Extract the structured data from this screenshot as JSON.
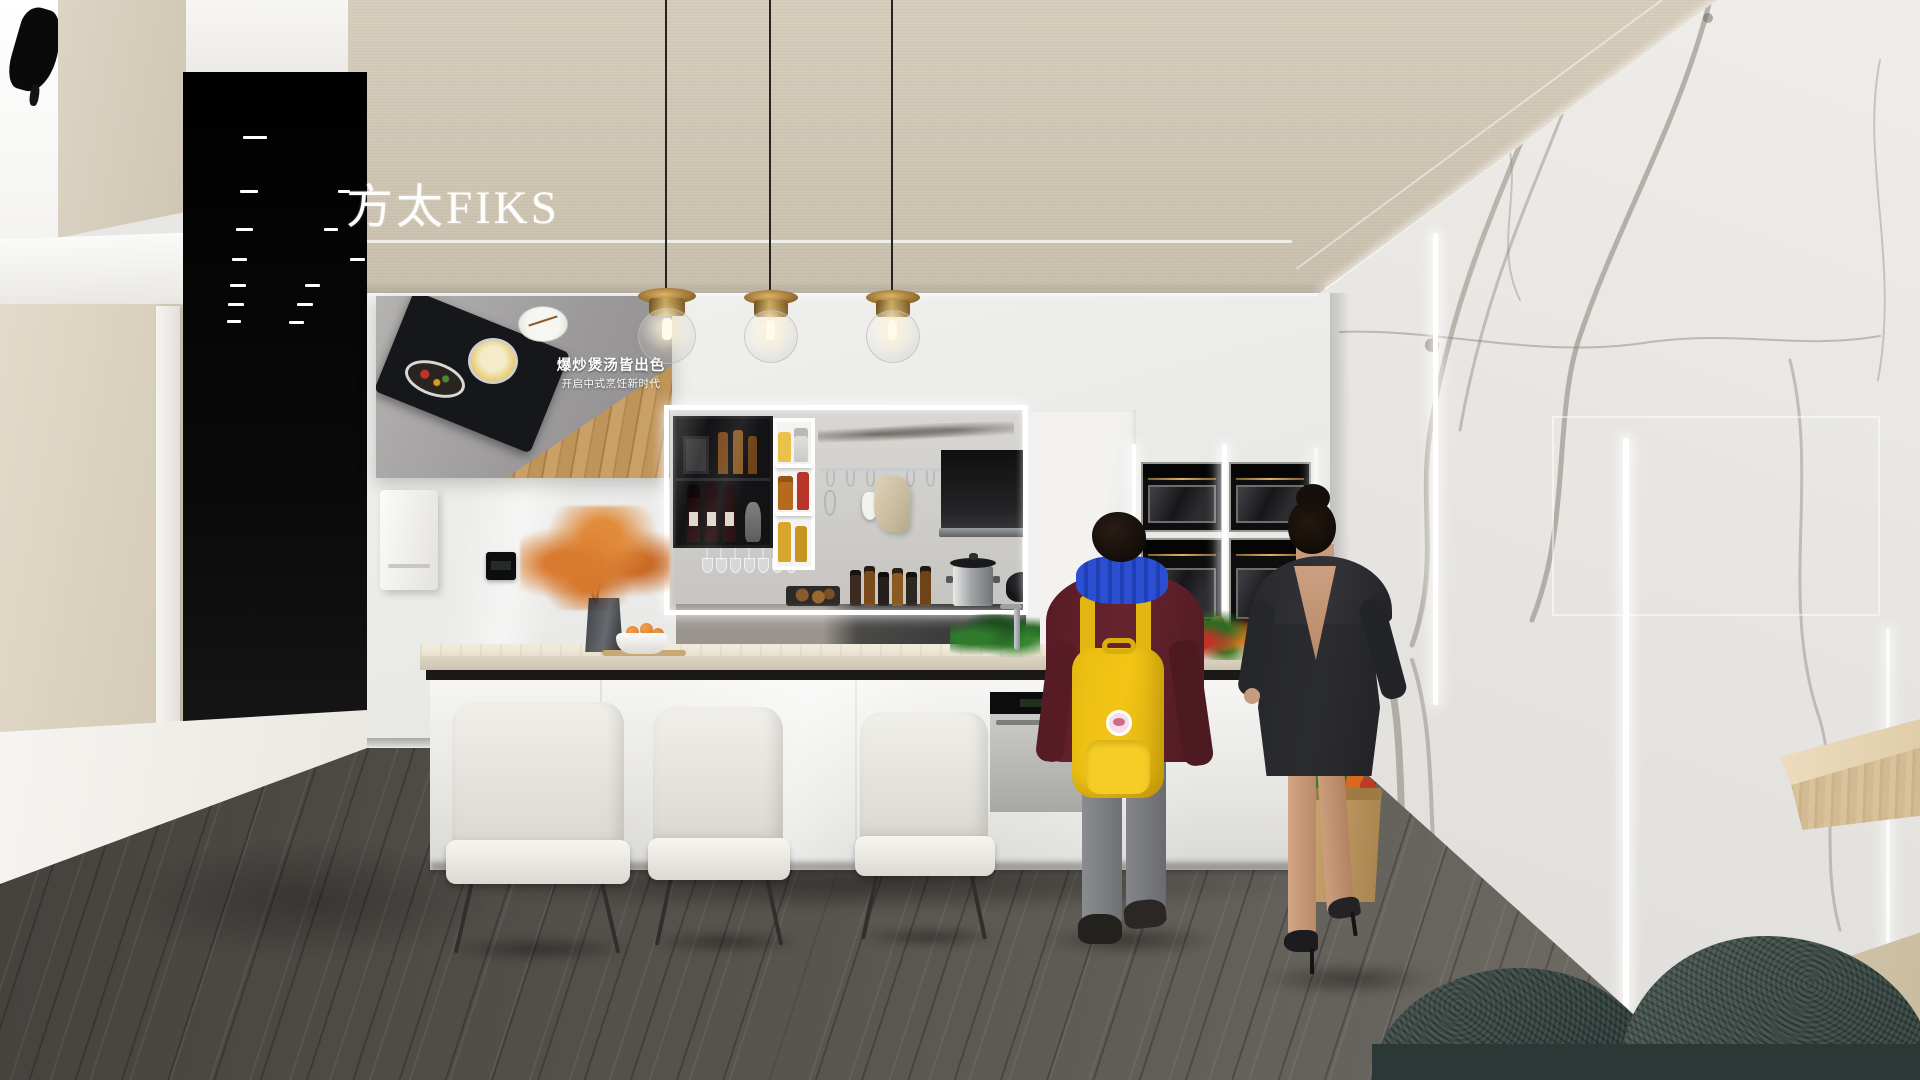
{
  "scene": {
    "title": "FOTILE FIKS kitchen showroom render",
    "brand_text": "方太FIKS",
    "poster": {
      "headline": "爆炒煲汤皆出色",
      "subline": "开启中式烹饪新时代"
    },
    "counts": {
      "pendant_lamps": 3,
      "bar_chairs": 3,
      "wall_ovens": 4,
      "people": 2
    },
    "palette": {
      "soffit-beige": "#d7cdbc",
      "soffit-beige-dark": "#c9bfad",
      "wall-white": "#efeeec",
      "column-black": "#060606",
      "marble-light": "#eae8e5",
      "marble-vein": "#8f887e",
      "floor-grey": "#56524d",
      "floor-white": "#f3f1ec",
      "island-counter": "#ece4d2",
      "cabinet-gloss": "#f2f1ef",
      "brass": "#b08849",
      "backpack-yellow": "#f2c516",
      "scarf-blue": "#2c4fd2",
      "sweater-maroon": "#67242f",
      "dress-charcoal": "#2b2c30",
      "skin": "#c79c7e",
      "sofa-teal": "#3f4b49",
      "bench-wood": "#dcc8a4",
      "flower-orange": "#d97b2e"
    }
  }
}
